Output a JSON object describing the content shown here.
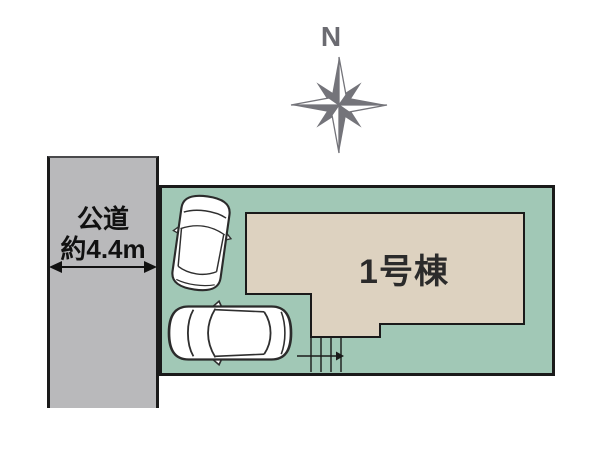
{
  "compass": {
    "north_label": "N",
    "color": "#6f6f75"
  },
  "road": {
    "label_line1": "公道",
    "label_line2": "約4.4m",
    "fill": "#b9b9bb"
  },
  "plot": {
    "fill": "#a1c8b6",
    "border_color": "#1a1a1a"
  },
  "building": {
    "label": "1号棟",
    "fill": "#ddd2c0",
    "text_color": "#2b2b2b"
  },
  "stairs": {
    "steps": 4,
    "arrow_direction": "right"
  },
  "parking": {
    "car_count": 2
  }
}
